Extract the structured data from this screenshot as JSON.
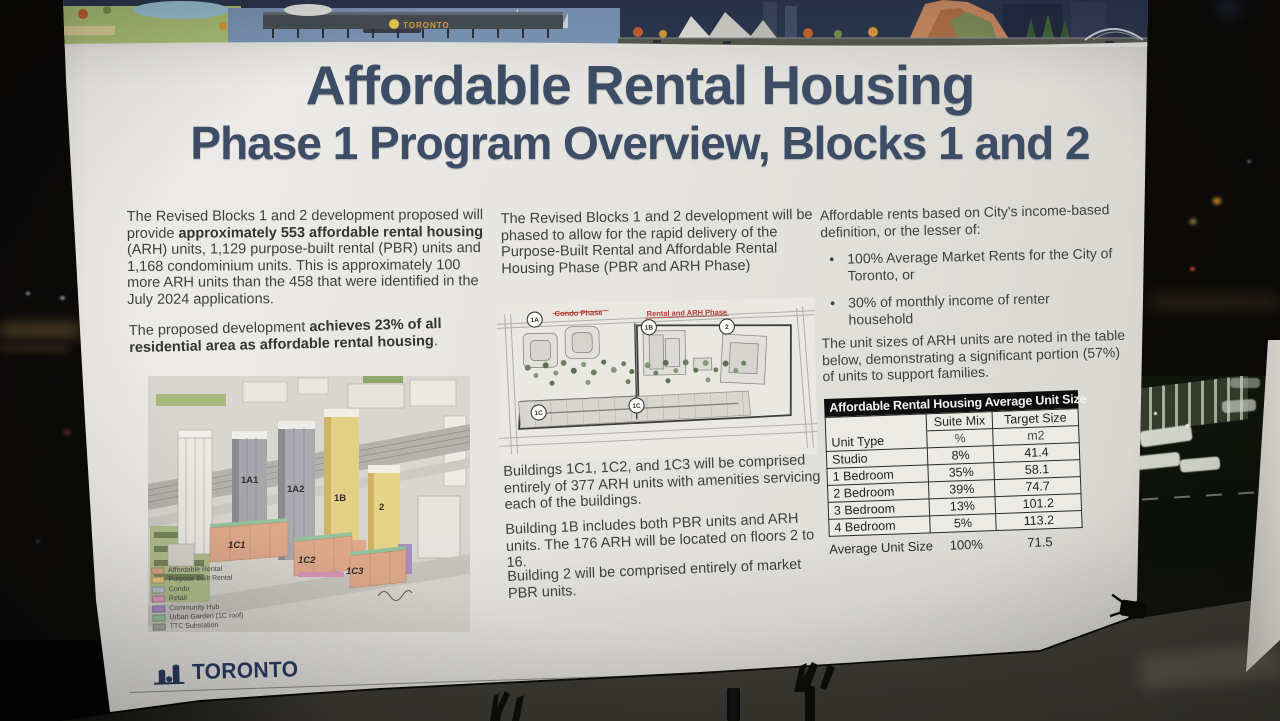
{
  "poster": {
    "banner": {
      "sign_text": "TORONTO"
    },
    "title": {
      "line1": "Affordable Rental Housing",
      "line2": "Phase 1 Program Overview, Blocks 1 and 2"
    },
    "left_column": {
      "paragraph1": {
        "seg1": "The Revised Blocks 1 and 2 development proposed will provide ",
        "seg2_bold": "approximately 553 affordable rental housing",
        "seg3": " (ARH) units, 1,129 purpose-built rental (PBR) units and 1,168 condominium units. This is approximately 100 more ARH units than the 458 that were identified in the July 2024 applications."
      },
      "paragraph2": {
        "seg1": "The proposed development ",
        "seg2_bold": "achieves 23% of all residential area as affordable rental housing",
        "seg3": "."
      },
      "render_labels": [
        "1A1",
        "1A2",
        "1B",
        "2",
        "1C1",
        "1C2",
        "1C3"
      ],
      "legend": [
        {
          "label": "Affordable Rental",
          "color": "#dfa88a"
        },
        {
          "label": "Purpose Built Rental",
          "color": "#e2c878"
        },
        {
          "label": "Condo",
          "color": "#b9c3cb"
        },
        {
          "label": "Retail",
          "color": "#dd9cbf"
        },
        {
          "label": "Community Hub",
          "color": "#a58fc8"
        },
        {
          "label": "Urban Garden (1C roof)",
          "color": "#96c29b"
        },
        {
          "label": "TTC Substation",
          "color": "#a6a6a4"
        }
      ]
    },
    "middle_column": {
      "paragraph1": "The Revised Blocks 1 and 2 development will be phased to allow for the rapid delivery of the Purpose-Built Rental and Affordable Rental Housing Phase (PBR and ARH Phase)",
      "siteplan": {
        "phase_left": "Condo Phase",
        "phase_right": "Rental and ARH Phase",
        "markers": [
          "1A",
          "1B",
          "2",
          "1C",
          "1C"
        ]
      },
      "paragraph2": "Buildings 1C1, 1C2, and 1C3 will be comprised entirely of 377 ARH units with amenities servicing each of the buildings.",
      "paragraph3": "Building 1B includes both PBR units and ARH units. The 176 ARH will be located on floors 2 to 16.",
      "paragraph4": "Building 2 will be comprised entirely of market PBR units."
    },
    "right_column": {
      "paragraph1": "Affordable rents based on City's income-based definition, or the lesser of:",
      "bullets": [
        "100% Average Market Rents for the City of Toronto, or",
        "30% of monthly income of renter household"
      ],
      "paragraph2": "The unit sizes of ARH units are noted in the table below, demonstrating a significant portion (57%) of units to support families.",
      "table": {
        "title": "Affordable Rental Housing Average Unit Size",
        "col1_header": "Unit Type",
        "col2_header": "Suite Mix",
        "col2_sub": "%",
        "col3_header": "Target Size",
        "col3_sub": "m2",
        "rows": [
          [
            "Studio",
            "8%",
            "41.4"
          ],
          [
            "1 Bedroom",
            "35%",
            "58.1"
          ],
          [
            "2 Bedroom",
            "39%",
            "74.7"
          ],
          [
            "3 Bedroom",
            "13%",
            "101.2"
          ],
          [
            "4 Bedroom",
            "5%",
            "113.2"
          ]
        ],
        "footer": [
          "Average Unit Size",
          "100%",
          "71.5"
        ]
      }
    },
    "footer": {
      "logo_text": "TORONTO"
    }
  }
}
